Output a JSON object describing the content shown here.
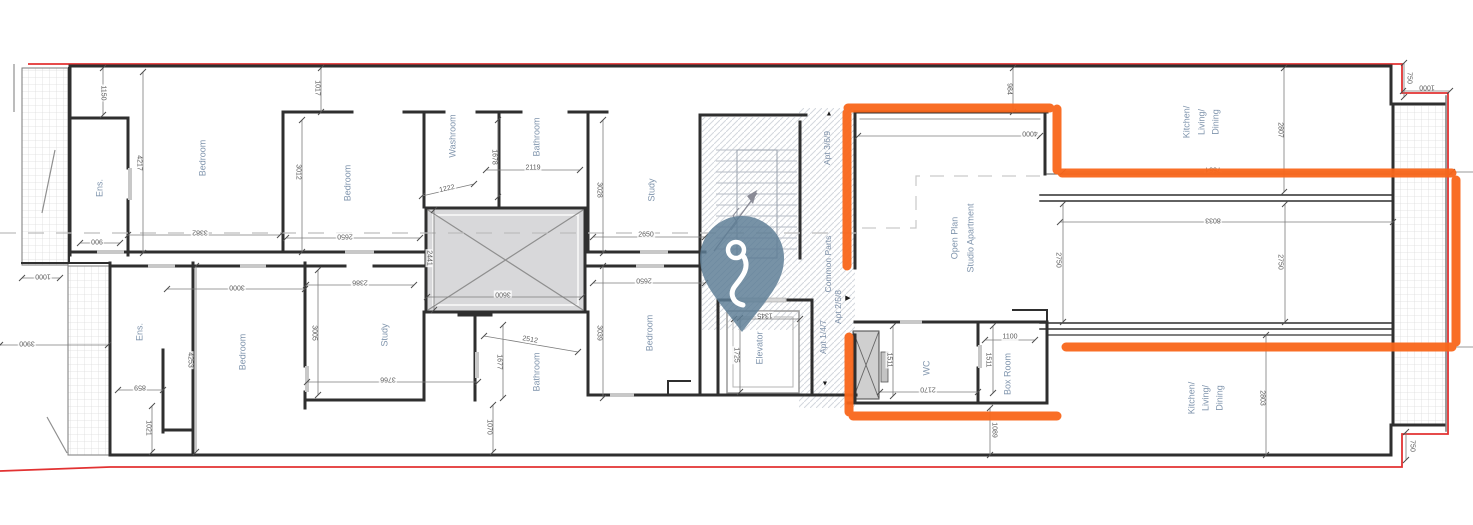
{
  "plan": {
    "type": "floor-plan",
    "colors": {
      "boundary": "#e23232",
      "highlight": "#f9661a",
      "pin": "#5d7d95",
      "room_label": "#8095ad",
      "dimension_text": "#5d5d5d",
      "wall": "#2f2f2f",
      "shaft_fill": "#d8d8da"
    },
    "rooms": [
      {
        "t": "Ens.",
        "x": 100,
        "y": 188
      },
      {
        "t": "Bedroom",
        "x": 203,
        "y": 158
      },
      {
        "t": "Bedroom",
        "x": 348,
        "y": 183
      },
      {
        "t": "Washroom",
        "x": 453,
        "y": 136
      },
      {
        "t": "Bathroom",
        "x": 537,
        "y": 137
      },
      {
        "t": "Study",
        "x": 652,
        "y": 190
      },
      {
        "t": "Elevator",
        "x": 760,
        "y": 348
      },
      {
        "t": "Open Plan",
        "x": 955,
        "y": 238
      },
      {
        "t": "Studio Apartment",
        "x": 971,
        "y": 238
      },
      {
        "t": "Kitchen/",
        "x": 1187,
        "y": 122
      },
      {
        "t": "Living/",
        "x": 1202,
        "y": 122
      },
      {
        "t": "Dining",
        "x": 1216,
        "y": 122
      },
      {
        "t": "Ens.",
        "x": 140,
        "y": 332
      },
      {
        "t": "Bedroom",
        "x": 243,
        "y": 352
      },
      {
        "t": "Study",
        "x": 385,
        "y": 335
      },
      {
        "t": "Bathroom",
        "x": 537,
        "y": 372
      },
      {
        "t": "Bedroom",
        "x": 650,
        "y": 333
      },
      {
        "t": "WC",
        "x": 927,
        "y": 368
      },
      {
        "t": "Box Room",
        "x": 1008,
        "y": 374
      },
      {
        "t": "Kitchen/",
        "x": 1192,
        "y": 398
      },
      {
        "t": "Living/",
        "x": 1206,
        "y": 398
      },
      {
        "t": "Dining",
        "x": 1220,
        "y": 398
      }
    ],
    "zones": [
      {
        "t": "Apt 3/6/9",
        "x": 827,
        "y": 148,
        "marker": "▲",
        "mx": 829,
        "my": 114
      },
      {
        "t": "Common Parts",
        "x": 828,
        "y": 264
      },
      {
        "t": "Apt 2/5/8",
        "x": 838,
        "y": 307,
        "marker": "▶",
        "mx": 848,
        "my": 298
      },
      {
        "t": "Apt 1/4/7",
        "x": 823,
        "y": 337,
        "marker": "▼",
        "mx": 825,
        "my": 384
      }
    ],
    "dimensions": [
      {
        "v": "1150",
        "x": 103,
        "y": 93,
        "r": 90,
        "l": [
          103,
          68,
          103,
          115
        ]
      },
      {
        "v": "4217",
        "x": 139,
        "y": 163,
        "r": 90,
        "l": [
          143,
          72,
          143,
          253
        ]
      },
      {
        "v": "1017",
        "x": 317,
        "y": 88,
        "r": 90,
        "l": [
          321,
          68,
          321,
          112
        ]
      },
      {
        "v": "3012",
        "x": 298,
        "y": 172,
        "r": 90,
        "l": [
          302,
          120,
          302,
          252
        ]
      },
      {
        "v": "900",
        "x": 97,
        "y": 241,
        "r": 180,
        "l": [
          80,
          243,
          120,
          243
        ]
      },
      {
        "v": "3382",
        "x": 200,
        "y": 232,
        "r": 180,
        "l": [
          128,
          235,
          280,
          235
        ]
      },
      {
        "v": "2650",
        "x": 345,
        "y": 236,
        "r": 180,
        "l": [
          286,
          238,
          420,
          238
        ]
      },
      {
        "v": "1000",
        "x": 43,
        "y": 276,
        "r": 180,
        "l": [
          22,
          278,
          60,
          278
        ]
      },
      {
        "v": "3900",
        "x": 27,
        "y": 343,
        "r": 180,
        "l": [
          0,
          345,
          108,
          345
        ]
      },
      {
        "v": "1222",
        "x": 447,
        "y": 189,
        "r": -12,
        "l": [
          422,
          196,
          474,
          184
        ]
      },
      {
        "v": "1678",
        "x": 494,
        "y": 157,
        "r": 90,
        "l": [
          498,
          120,
          498,
          197
        ]
      },
      {
        "v": "2119",
        "x": 533,
        "y": 168,
        "r": 0,
        "l": [
          486,
          170,
          580,
          170
        ]
      },
      {
        "v": "2441",
        "x": 429,
        "y": 258,
        "r": 90,
        "l": [
          434,
          210,
          434,
          310
        ]
      },
      {
        "v": "3600",
        "x": 503,
        "y": 294,
        "r": 180,
        "l": [
          427,
          297,
          582,
          297
        ]
      },
      {
        "v": "3028",
        "x": 599,
        "y": 190,
        "r": 90,
        "l": [
          603,
          120,
          603,
          253
        ]
      },
      {
        "v": "2650",
        "x": 646,
        "y": 235,
        "r": 0,
        "l": [
          593,
          237,
          705,
          237
        ]
      },
      {
        "v": "2650",
        "x": 644,
        "y": 280,
        "r": 180,
        "l": [
          593,
          283,
          705,
          283
        ]
      },
      {
        "v": "984",
        "x": 1009,
        "y": 89,
        "r": 90,
        "l": [
          1013,
          68,
          1013,
          112
        ]
      },
      {
        "v": "4000",
        "x": 1030,
        "y": 133,
        "r": 180,
        "l": [
          858,
          136,
          1040,
          136
        ]
      },
      {
        "v": "2807",
        "x": 1280,
        "y": 130,
        "r": 90,
        "l": [
          1284,
          68,
          1284,
          192
        ]
      },
      {
        "v": "750",
        "x": 1409,
        "y": 78,
        "r": 90,
        "l": [
          1404,
          63,
          1404,
          97
        ]
      },
      {
        "v": "1000",
        "x": 1427,
        "y": 87,
        "r": 180,
        "l": [
          1403,
          91,
          1450,
          91
        ]
      },
      {
        "v": "7554",
        "x": 1213,
        "y": 169,
        "r": 180,
        "l": [
          1063,
          172,
          1452,
          172
        ]
      },
      {
        "v": "8033",
        "x": 1213,
        "y": 220,
        "r": 180,
        "l": [
          1060,
          222,
          1393,
          222
        ]
      },
      {
        "v": "2750",
        "x": 1058,
        "y": 260,
        "r": 90,
        "l": [
          1063,
          204,
          1063,
          322
        ]
      },
      {
        "v": "2750",
        "x": 1280,
        "y": 262,
        "r": 90,
        "l": [
          1285,
          204,
          1285,
          322
        ]
      },
      {
        "v": "3000",
        "x": 237,
        "y": 287,
        "r": 180,
        "l": [
          167,
          289,
          305,
          289
        ]
      },
      {
        "v": "2386",
        "x": 360,
        "y": 282,
        "r": 180,
        "l": [
          306,
          285,
          414,
          285
        ]
      },
      {
        "v": "3005",
        "x": 314,
        "y": 333,
        "r": 90,
        "l": [
          318,
          270,
          318,
          395
        ]
      },
      {
        "v": "859",
        "x": 140,
        "y": 387,
        "r": 180,
        "l": [
          118,
          390,
          163,
          390
        ]
      },
      {
        "v": "1021",
        "x": 148,
        "y": 428,
        "r": 90,
        "l": [
          152,
          406,
          152,
          452
        ]
      },
      {
        "v": "4253",
        "x": 190,
        "y": 360,
        "r": 90,
        "l": [
          196,
          266,
          196,
          452
        ]
      },
      {
        "v": "3766",
        "x": 388,
        "y": 379,
        "r": 180,
        "l": [
          307,
          382,
          478,
          382
        ]
      },
      {
        "v": "2512",
        "x": 530,
        "y": 340,
        "r": 10,
        "l": [
          484,
          336,
          578,
          352
        ]
      },
      {
        "v": "1677",
        "x": 499,
        "y": 362,
        "r": 90,
        "l": [
          503,
          325,
          503,
          398
        ]
      },
      {
        "v": "1070",
        "x": 489,
        "y": 427,
        "r": 90,
        "l": [
          493,
          405,
          493,
          452
        ]
      },
      {
        "v": "3039",
        "x": 599,
        "y": 333,
        "r": 90,
        "l": [
          603,
          266,
          603,
          398
        ]
      },
      {
        "v": "1345",
        "x": 765,
        "y": 315,
        "r": 180,
        "l": [
          734,
          319,
          800,
          319
        ]
      },
      {
        "v": "1725",
        "x": 736,
        "y": 355,
        "r": 90,
        "l": [
          740,
          318,
          740,
          392
        ]
      },
      {
        "v": "1511",
        "x": 889,
        "y": 360,
        "r": 90,
        "l": [
          893,
          326,
          893,
          396
        ]
      },
      {
        "v": "2170",
        "x": 928,
        "y": 389,
        "r": 180,
        "l": [
          880,
          392,
          978,
          392
        ]
      },
      {
        "v": "1511",
        "x": 988,
        "y": 360,
        "r": 90,
        "l": [
          993,
          326,
          993,
          393
        ]
      },
      {
        "v": "1100",
        "x": 1010,
        "y": 337,
        "r": 0,
        "l": [
          985,
          340,
          1035,
          340
        ]
      },
      {
        "v": "1089",
        "x": 994,
        "y": 430,
        "r": 90,
        "l": [
          990,
          408,
          990,
          455
        ]
      },
      {
        "v": "2803",
        "x": 1262,
        "y": 398,
        "r": 90,
        "l": [
          1266,
          335,
          1266,
          455
        ]
      },
      {
        "v": "750",
        "x": 1412,
        "y": 446,
        "r": 90,
        "l": [
          1406,
          432,
          1406,
          460
        ]
      }
    ]
  }
}
